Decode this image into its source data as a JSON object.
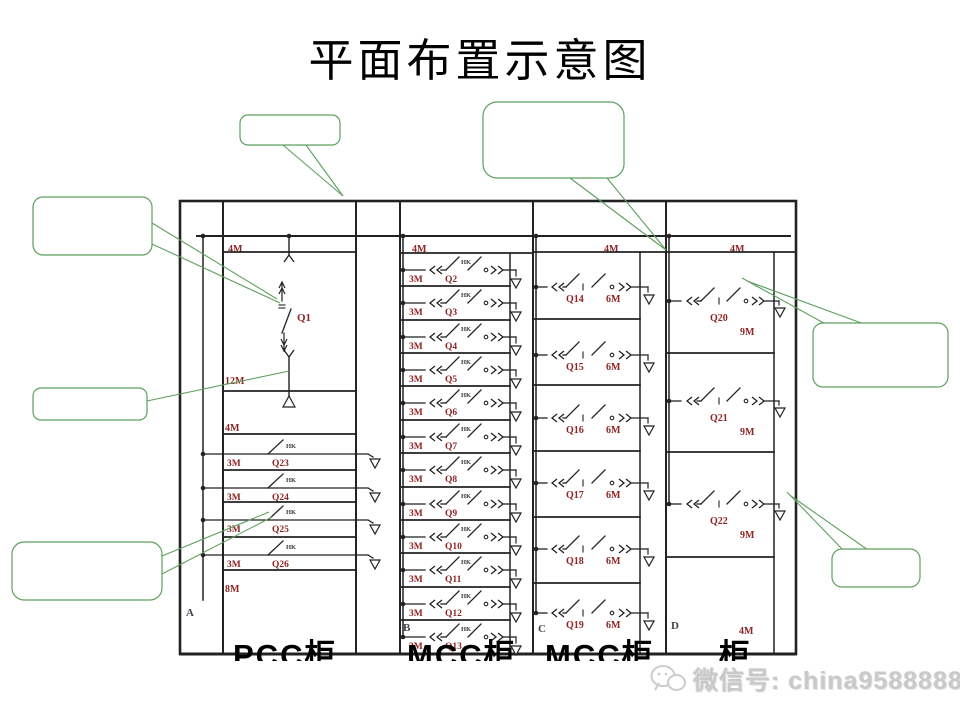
{
  "title": "平面布置示意图",
  "watermark": {
    "icon": "wechat-icon",
    "text": "微信号: china9588888"
  },
  "bottom_labels": [
    "PCC柜",
    "MCC柜",
    "MCC柜",
    "柜"
  ],
  "colors": {
    "line": "#222222",
    "label_red": "#8d2525",
    "mark_dark": "#3a3a3a",
    "section_gray": "#44444f",
    "callout_green": "#5ea05e",
    "watermark_gray": "#c9c9c9"
  },
  "diagram": {
    "bus_sizes": {
      "pcc": "4M",
      "mcc1": "4M",
      "mcc2": "4M",
      "mcc3": "4M"
    },
    "panels": {
      "pcc": {
        "section_label": "A",
        "incomer": {
          "name": "Q1",
          "size": "12M"
        },
        "ground_size": "4M",
        "feeders": [
          {
            "name": "Q23",
            "size": "3M",
            "mark": "HK"
          },
          {
            "name": "Q24",
            "size": "3M",
            "mark": "HK"
          },
          {
            "name": "Q25",
            "size": "3M",
            "mark": "HK"
          },
          {
            "name": "Q26",
            "size": "3M",
            "mark": "HK"
          }
        ],
        "spare_size": "8M"
      },
      "mcc1": {
        "section_label": "B",
        "feeders": [
          {
            "name": "Q2",
            "size": "3M",
            "mark": "HK"
          },
          {
            "name": "Q3",
            "size": "3M",
            "mark": "HK"
          },
          {
            "name": "Q4",
            "size": "3M",
            "mark": "HK"
          },
          {
            "name": "Q5",
            "size": "3M",
            "mark": "HK"
          },
          {
            "name": "Q6",
            "size": "3M",
            "mark": "HK"
          },
          {
            "name": "Q7",
            "size": "3M",
            "mark": "HK"
          },
          {
            "name": "Q8",
            "size": "3M",
            "mark": "HK"
          },
          {
            "name": "Q9",
            "size": "3M",
            "mark": "HK"
          },
          {
            "name": "Q10",
            "size": "3M",
            "mark": "HK"
          },
          {
            "name": "Q11",
            "size": "3M",
            "mark": "HK"
          },
          {
            "name": "Q12",
            "size": "3M",
            "mark": "HK"
          },
          {
            "name": "Q13",
            "size": "3M",
            "mark": "HK"
          }
        ]
      },
      "mcc2": {
        "section_label": "C",
        "feeders": [
          {
            "name": "Q14",
            "size": "6M"
          },
          {
            "name": "Q15",
            "size": "6M"
          },
          {
            "name": "Q16",
            "size": "6M"
          },
          {
            "name": "Q17",
            "size": "6M"
          },
          {
            "name": "Q18",
            "size": "6M"
          },
          {
            "name": "Q19",
            "size": "6M"
          }
        ]
      },
      "mcc3": {
        "section_label": "D",
        "bottom_size": "4M",
        "feeders": [
          {
            "name": "Q20",
            "size": "9M"
          },
          {
            "name": "Q21",
            "size": "9M"
          },
          {
            "name": "Q22",
            "size": "9M"
          }
        ]
      }
    },
    "callouts": [
      {
        "id": "callout-1",
        "label": ""
      },
      {
        "id": "callout-2",
        "label": ""
      },
      {
        "id": "callout-3",
        "label": ""
      },
      {
        "id": "callout-4",
        "label": ""
      },
      {
        "id": "callout-5",
        "label": ""
      },
      {
        "id": "callout-6",
        "label": ""
      },
      {
        "id": "callout-7",
        "label": ""
      }
    ]
  }
}
